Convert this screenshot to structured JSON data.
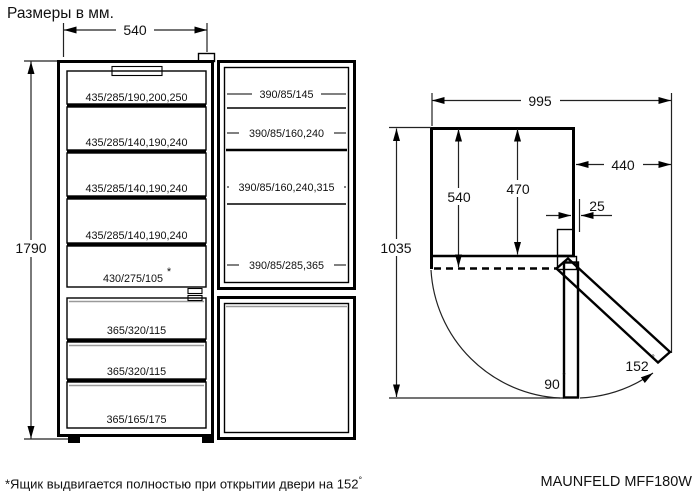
{
  "title": "Размеры в мм.",
  "front_view": {
    "width_mm": "540",
    "height_mm": "1790",
    "fridge_shelves": [
      "435/285/190,200,250",
      "435/285/140,190,240",
      "435/285/140,190,240",
      "435/285/140,190,240"
    ],
    "crisper": {
      "label": "430/275/105",
      "mark": "*"
    },
    "freezer_drawers": [
      "365/320/115",
      "365/320/115",
      "365/165/175"
    ],
    "door_shelves": [
      "390/85/145",
      "390/85/160,240",
      "390/85/160,240,315",
      "390/85/285,365"
    ]
  },
  "side_view": {
    "total_depth_open_mm": "995",
    "door_clearance_mm": "440",
    "depth_with_door_mm": "540",
    "depth_body_mm": "470",
    "hinge_offset_mm": "25",
    "depth_door_90_mm": "1035",
    "angle_open": "90",
    "angle_max": "152",
    "degree_sign": "°"
  },
  "footer": {
    "note": "*Ящик выдвигается полностью при открытии двери на 152",
    "note_degree": "°",
    "model": "MAUNFELD MFF180W"
  }
}
